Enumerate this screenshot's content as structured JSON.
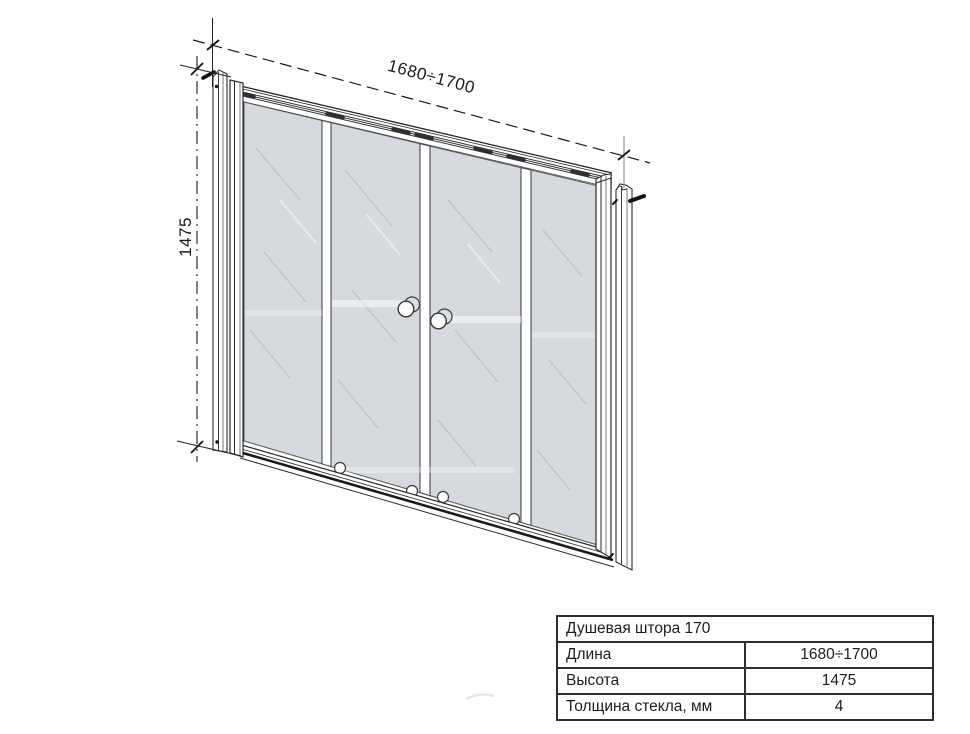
{
  "drawing": {
    "width_dimension": "1680÷1700",
    "height_dimension": "1475",
    "glass_color": "#d6d9dd",
    "line_color": "#2a2a2a"
  },
  "table": {
    "title": "Душевая штора 170",
    "rows": [
      {
        "label": "Длина",
        "value": "1680÷1700"
      },
      {
        "label": "Высота",
        "value": "1475"
      },
      {
        "label": "Толщина стекла, мм",
        "value": "4"
      }
    ]
  }
}
